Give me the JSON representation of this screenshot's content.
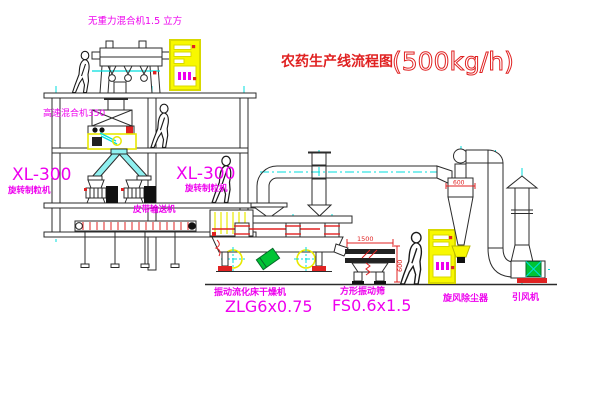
{
  "title": {
    "part1": "农药生产线流程图",
    "part2": "(500kg/h)"
  },
  "labels": {
    "gravity_mixer": "无重力混合机1.5 立方",
    "high_speed_mixer": "高速混合机350",
    "granulator_left_model": "XL-300",
    "granulator_left_name": "旋转制粒机",
    "granulator_right_model": "XL-300",
    "granulator_right_name": "旋转制粒机",
    "belt_conveyor": "皮带输送机",
    "dryer_name": "振动流化床干燥机",
    "dryer_model": "ZLG6x0.75",
    "sieve_name": "方形振动筛",
    "sieve_model": "FS0.6x1.5",
    "cyclone_name": "旋风除尘器",
    "fan_name": "引风机"
  },
  "dimensions": {
    "sieve_length": "1500",
    "sieve_height": "600",
    "cyclone_diameter": "600"
  },
  "colors": {
    "label_magenta": "#ee00ee",
    "title_red": "#e02222",
    "centerline_cyan": "#00dede",
    "cabinet_yellow": "#f8f800",
    "machine_green": "#00c435",
    "line_dark": "#2b2b2b"
  }
}
